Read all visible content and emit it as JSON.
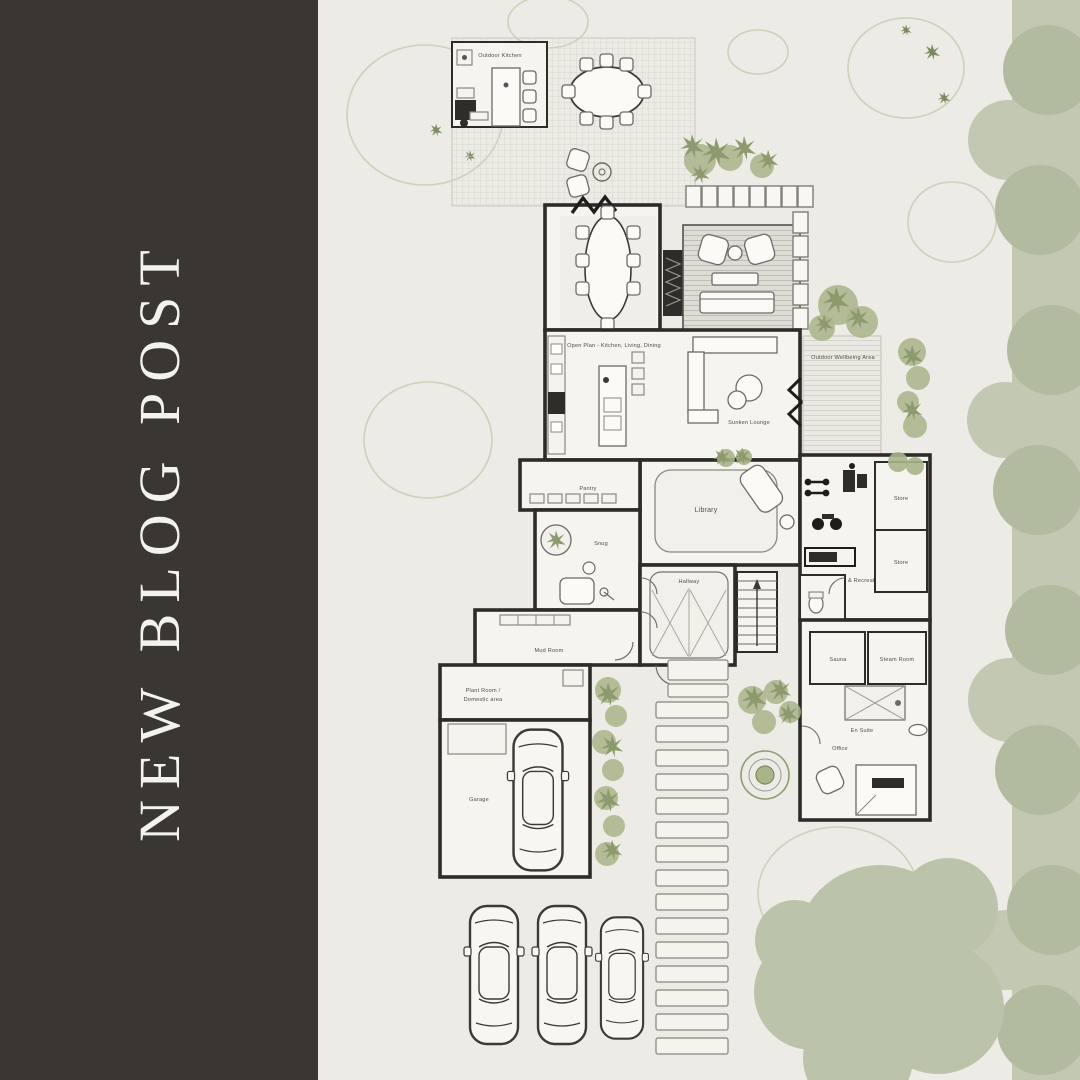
{
  "left_panel": {
    "title": "NEW BLOG POST"
  },
  "plan": {
    "labels": {
      "outdoor_kitchen": "Outdoor Kitchen",
      "open_plan": "Open Plan - Kitchen, Living, Dining",
      "wellbeing": "Outdoor Wellbeing Area",
      "sunken_lounge": "Sunken Lounge",
      "library": "Library",
      "pantry": "Pantry",
      "snug": "Snug",
      "hallway": "Hallway",
      "mud_room": "Mud Room",
      "plant_room_line1": "Plant Room /",
      "plant_room_line2": "Domestic area",
      "garage": "Garage",
      "gym": "Gym & Recreation Suite",
      "en_suite": "En Suite",
      "office": "Office",
      "sauna": "Sauna",
      "steam_room": "Steam Room",
      "store_1": "Store",
      "store_2": "Store"
    }
  },
  "theme": {
    "panel_bg": "#3a3733",
    "page_bg": "#ecebe5",
    "title_color": "#f3f2ee",
    "wall": "#2e2c28",
    "sage": "#bcc3ab",
    "olive": "#8d9a6e",
    "label": "#504e48"
  }
}
